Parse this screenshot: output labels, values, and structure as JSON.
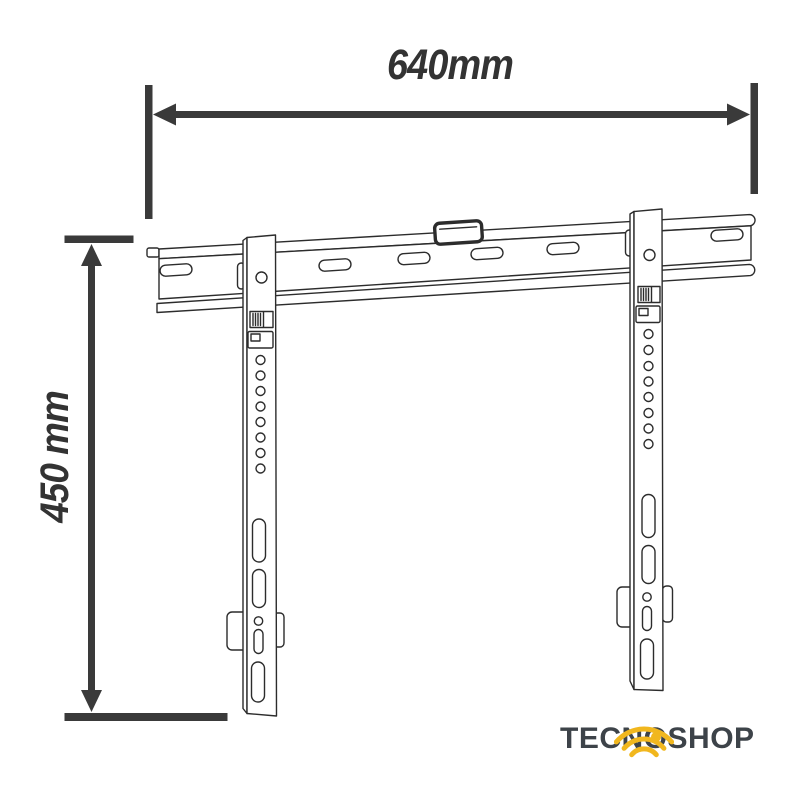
{
  "figure": {
    "subject": "fixed TV wall mount bracket, front line drawing",
    "width_mm": 640,
    "height_mm": 450
  },
  "dimensions": {
    "width_label": "640mm",
    "height_label": "450 mm"
  },
  "logo": {
    "text": "TECNOSHOP",
    "part1": "TECN",
    "o": "O",
    "part2": "SHOP",
    "text_color": "#3d4349",
    "accent_color": "#F1B71E"
  },
  "colors": {
    "background": "#ffffff",
    "dimension_lines": "#3a3a3a",
    "drawing_lines": "#2c2c2c"
  }
}
